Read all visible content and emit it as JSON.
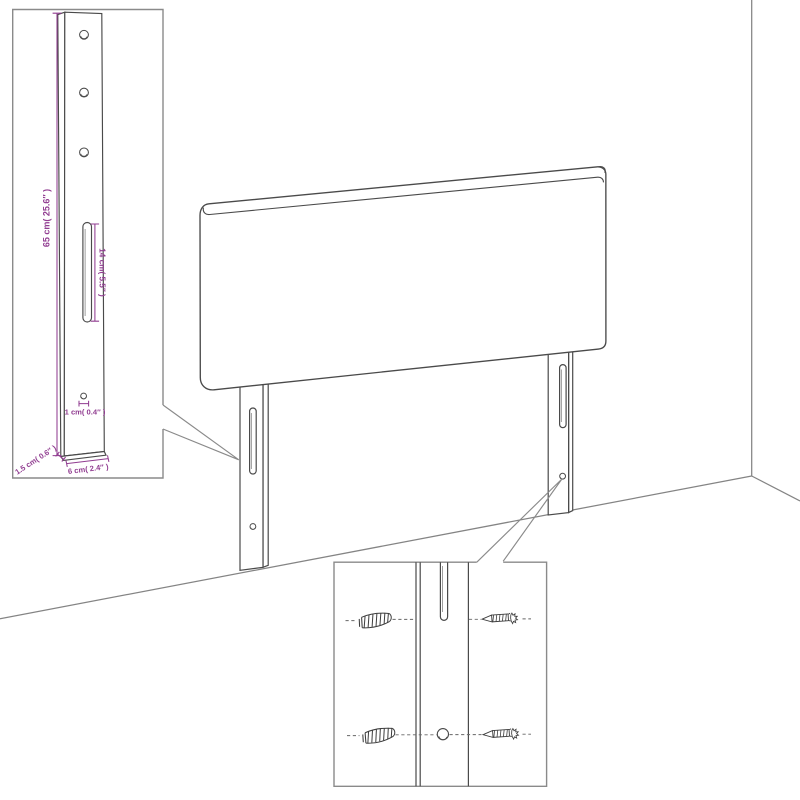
{
  "diagram": {
    "subject": "headboard wall-mounting assembly drawing",
    "colors": {
      "background": "#ffffff",
      "furniture_line": "#4a4a4a",
      "room_line": "#848484",
      "inset_border": "#8a8a8a",
      "dimension": "#913d91"
    }
  },
  "left_inset": {
    "dim_height": "65 cm( 25.6″ )",
    "dim_slot_length": "14 cm( 5.5″ )",
    "dim_hole": "1 cm( 0.4″ )",
    "dim_thickness": "1.5 cm( 0.6″ )",
    "dim_width": "6 cm( 2.4″ )",
    "hole_count": 3
  },
  "detail_inset": {
    "rows": 2,
    "left_hardware": "wall-anchor",
    "right_hardware": "screw"
  }
}
